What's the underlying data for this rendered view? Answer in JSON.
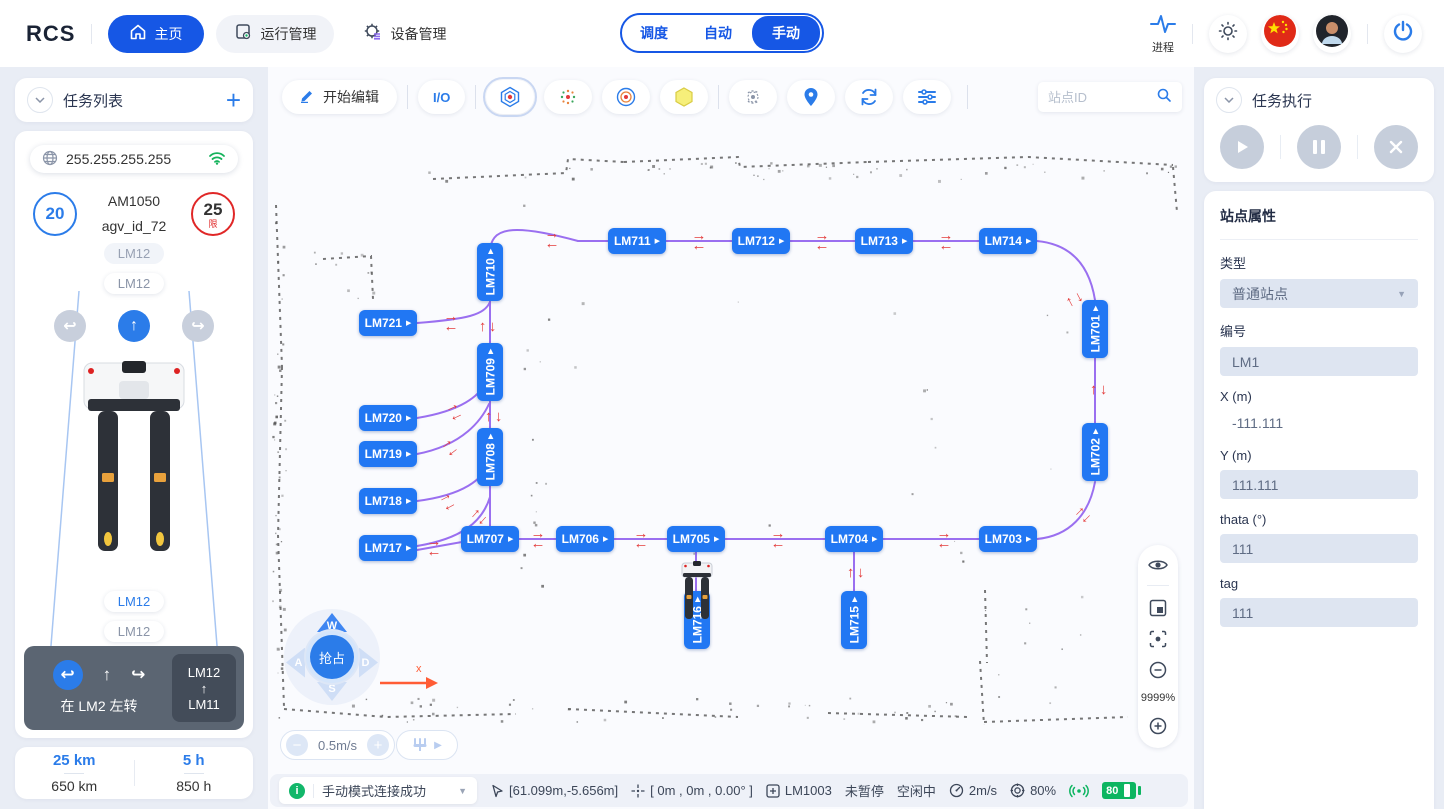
{
  "topbar": {
    "logo": "RCS",
    "nav": [
      {
        "label": "主页"
      },
      {
        "label": "运行管理"
      },
      {
        "label": "设备管理"
      }
    ],
    "modes": [
      {
        "label": "调度"
      },
      {
        "label": "自动"
      },
      {
        "label": "手动"
      }
    ],
    "process_label": "进程"
  },
  "left": {
    "task_list_title": "任务列表",
    "add_label": "+",
    "ip": "255.255.255.255",
    "speed_value": "20",
    "limit_value": "25",
    "limit_suffix": "限",
    "model": "AM1050",
    "agv_id": "agv_id_72",
    "chip_top1": "LM12",
    "chip_top2": "LM12",
    "chip_bottom1": "LM12",
    "chip_bottom2": "LM12",
    "turn_left_icon": "↩",
    "up_icon": "↑",
    "turn_right_icon": "↪",
    "nav_hint": "在 LM2 左转",
    "route_from": "LM12",
    "route_arrow": "↑",
    "route_to": "LM11",
    "km_current": "25 km",
    "km_total": "650 km",
    "h_current": "5 h",
    "h_total": "850 h"
  },
  "map": {
    "edit_label": "开始编辑",
    "io_label": "I/O",
    "search_placeholder": "站点ID",
    "zoom_label": "9999%",
    "speed_control": "0.5m/s",
    "joystick": {
      "center": "抢占",
      "up": "W",
      "left": "A",
      "down": "S",
      "right": "D",
      "axis": "x"
    },
    "stations": [
      {
        "id": "LM711",
        "x": 369,
        "y": 174
      },
      {
        "id": "LM712",
        "x": 493,
        "y": 174
      },
      {
        "id": "LM713",
        "x": 616,
        "y": 174
      },
      {
        "id": "LM714",
        "x": 740,
        "y": 174
      },
      {
        "id": "LM710",
        "x": 222,
        "y": 205,
        "v": true
      },
      {
        "id": "LM701",
        "x": 827,
        "y": 262,
        "v": true
      },
      {
        "id": "LM702",
        "x": 827,
        "y": 385,
        "v": true
      },
      {
        "id": "LM703",
        "x": 740,
        "y": 472
      },
      {
        "id": "LM704",
        "x": 586,
        "y": 472
      },
      {
        "id": "LM705",
        "x": 428,
        "y": 472
      },
      {
        "id": "LM706",
        "x": 317,
        "y": 472
      },
      {
        "id": "LM707",
        "x": 222,
        "y": 472
      },
      {
        "id": "LM708",
        "x": 222,
        "y": 390,
        "v": true
      },
      {
        "id": "LM709",
        "x": 222,
        "y": 305,
        "v": true
      },
      {
        "id": "LM715",
        "x": 586,
        "y": 553,
        "v": true
      },
      {
        "id": "LM716",
        "x": 429,
        "y": 553,
        "v": true
      },
      {
        "id": "LM717",
        "x": 120,
        "y": 481
      },
      {
        "id": "LM718",
        "x": 120,
        "y": 434
      },
      {
        "id": "LM719",
        "x": 120,
        "y": 387
      },
      {
        "id": "LM720",
        "x": 120,
        "y": 351
      },
      {
        "id": "LM721",
        "x": 120,
        "y": 256
      }
    ],
    "arrows": [
      {
        "x": 284,
        "y": 172,
        "rot": 0
      },
      {
        "x": 431,
        "y": 174,
        "rot": 0
      },
      {
        "x": 554,
        "y": 174,
        "rot": 0
      },
      {
        "x": 678,
        "y": 174,
        "rot": 0
      },
      {
        "x": 808,
        "y": 232,
        "rot": 62
      },
      {
        "x": 829,
        "y": 323,
        "rot": -90
      },
      {
        "x": 814,
        "y": 447,
        "rot": -45
      },
      {
        "x": 676,
        "y": 472,
        "rot": 0
      },
      {
        "x": 510,
        "y": 472,
        "rot": 0
      },
      {
        "x": 373,
        "y": 472,
        "rot": 0
      },
      {
        "x": 270,
        "y": 472,
        "rot": 0
      },
      {
        "x": 166,
        "y": 480,
        "rot": 0
      },
      {
        "x": 183,
        "y": 255,
        "rot": 0
      },
      {
        "x": 218,
        "y": 260,
        "rot": -90
      },
      {
        "x": 186,
        "y": 344,
        "rot": -25
      },
      {
        "x": 181,
        "y": 380,
        "rot": -38
      },
      {
        "x": 179,
        "y": 434,
        "rot": -28
      },
      {
        "x": 224,
        "y": 350,
        "rot": -90
      },
      {
        "x": 210,
        "y": 449,
        "rot": -48
      },
      {
        "x": 586,
        "y": 506,
        "rot": -90
      }
    ],
    "paths": [
      "M310,174 L740,174",
      "M222,186 C222,160 244,156 310,174",
      "M149,256 C200,252 216,248 222,235",
      "M222,234 L222,277",
      "M222,333 L222,362",
      "M149,351 C192,344 212,330 221,311",
      "M149,387 C196,378 214,352 221,337",
      "M149,434 C196,428 215,412 221,396",
      "M222,418 L222,459",
      "M222,430 C214,456 192,472 149,479",
      "M149,483 L222,470",
      "M251,472 L711,472",
      "M428,485 L428,525",
      "M586,485 L586,525",
      "M769,472 C801,469 821,448 827,415",
      "M827,356 L827,291",
      "M827,233 C821,196 801,177 769,174"
    ]
  },
  "right": {
    "exec_title": "任务执行",
    "props_title": "站点属性",
    "fields": [
      {
        "label": "类型",
        "value": "普通站点",
        "kind": "select"
      },
      {
        "label": "编号",
        "value": "LM1",
        "kind": "input"
      },
      {
        "label": "X (m)",
        "value": "-111.111",
        "kind": "plain"
      },
      {
        "label": "Y (m)",
        "value": "111.111",
        "kind": "input"
      },
      {
        "label": "thata (°)",
        "value": "111",
        "kind": "input"
      },
      {
        "label": "tag",
        "value": "111",
        "kind": "input"
      }
    ]
  },
  "statusbar": {
    "info_icon": "i",
    "message": "手动模式连接成功",
    "cursor_pos": "[61.099m,-5.656m]",
    "robot_pose": "[ 0m , 0m , 0.00° ]",
    "station": "LM1003",
    "pause_state": "未暂停",
    "run_state": "空闲中",
    "speed": "2m/s",
    "confidence": "80%",
    "battery": "80"
  }
}
